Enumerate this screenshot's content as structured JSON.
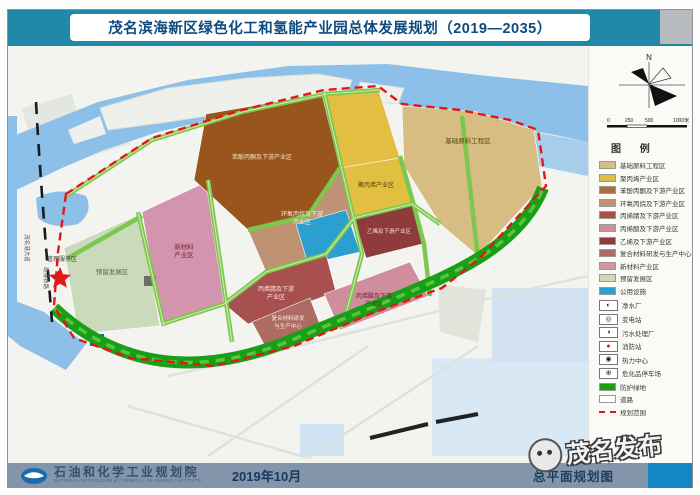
{
  "header": {
    "title": "茂名滨海新区绿色化工和氢能产业园总体发展规划（2019—2035）"
  },
  "map": {
    "north_label": "N",
    "scale_ticks": [
      "0",
      "250",
      "500",
      "1000米"
    ],
    "zones": {
      "reserved": "预留发展区",
      "new_material_1": "新材料",
      "new_material_2": "产业区",
      "phenol_acetone": "苯酚丙酮及下游产业区",
      "base_material": "基础原料工程区",
      "polypropylene": "聚丙烯产业区",
      "propylene_oxide_1": "环氧丙烷及下游",
      "propylene_oxide_2": "产业区",
      "acrylonitrile_1": "丙烯腈及下游",
      "acrylonitrile_2": "产业区",
      "ethylene": "乙烯及下游产业区",
      "composite_1": "复合材料研发",
      "composite_2": "与生产中心",
      "acrylic_acid_1": "丙烯酸及下游",
      "acrylic_acid_2": "产业区",
      "management": "管理服务区"
    },
    "roads": {
      "railway": "疏港铁路",
      "avenue": "茂名港大道"
    }
  },
  "legend": {
    "title": "图 例",
    "areas": [
      {
        "label": "基础原料工程区",
        "color": "#d8bd82"
      },
      {
        "label": "聚丙烯产业区",
        "color": "#e3bf41"
      },
      {
        "label": "苯酚丙酮及下游产业区",
        "color": "#a4713a"
      },
      {
        "label": "环氧丙烷及下游产业区",
        "color": "#bf9274"
      },
      {
        "label": "丙烯腈及下游产业区",
        "color": "#a85050"
      },
      {
        "label": "丙烯酸及下游产业区",
        "color": "#cf8d9e"
      },
      {
        "label": "乙烯及下游产业区",
        "color": "#8e3b3b"
      },
      {
        "label": "复合材料研发与生产中心",
        "color": "#ad6b62"
      },
      {
        "label": "新材料产业区",
        "color": "#d394ad"
      },
      {
        "label": "预留发展区",
        "color": "#ccdabc"
      },
      {
        "label": "公用设施",
        "color": "#2b9fd0"
      }
    ],
    "symbols": [
      {
        "type": "glyph",
        "glyph": "◐",
        "color": "#1a1a1a",
        "label": "净水厂"
      },
      {
        "type": "glyph",
        "glyph": "◎",
        "color": "#1a1a1a",
        "label": "变电站"
      },
      {
        "type": "glyph",
        "glyph": "◑",
        "color": "#1a1a1a",
        "label": "污水处理厂"
      },
      {
        "type": "glyph",
        "glyph": "●",
        "color": "#d81818",
        "label": "消防站"
      },
      {
        "type": "glyph",
        "glyph": "◉",
        "color": "#1a1a1a",
        "label": "热力中心"
      },
      {
        "type": "glyph",
        "glyph": "⊕",
        "color": "#1a1a1a",
        "label": "危化品停车场"
      },
      {
        "type": "swatch",
        "color": "#17a017",
        "label": "防护绿地"
      },
      {
        "type": "swatch",
        "color": "#ffffff",
        "label": "道路"
      },
      {
        "type": "boundary",
        "color": "#d81818",
        "label": "规划范围"
      }
    ]
  },
  "footer": {
    "institute": "石油和化学工业规划院",
    "institute_en": "NATIONAL PETROLEUM & CHEMICAL PLANNING INSTITUTE",
    "date": "2019年10月",
    "drawing_title": "总平面规划图"
  },
  "watermark": {
    "text": "茂名发布"
  },
  "colors": {
    "header_teal": "#2089a8",
    "footer_slate": "#8295aa",
    "boundary_red": "#e01818",
    "road_green": "#7cc74e",
    "belt_green": "#17a017",
    "water_blue": "#8cc0e8"
  }
}
